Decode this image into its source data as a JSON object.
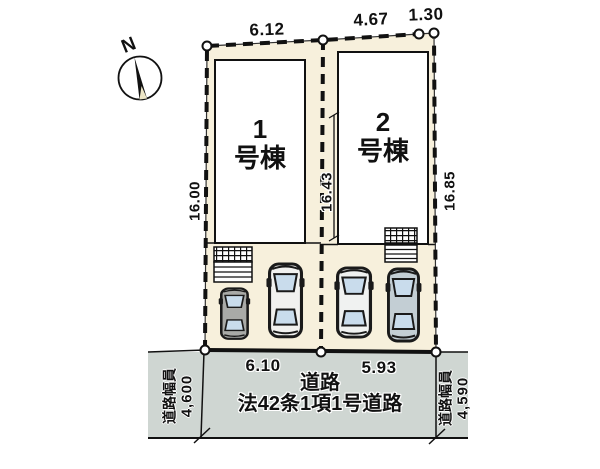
{
  "compass": {
    "north_label": "N"
  },
  "plot": {
    "buildings": [
      {
        "number": "1",
        "suffix": "号棟"
      },
      {
        "number": "2",
        "suffix": "号棟"
      }
    ],
    "dims": {
      "top_left": "6.12",
      "top_mid": "4.67",
      "top_right": "1.30",
      "side_left": "16.00",
      "side_mid": "16.43",
      "side_right": "16.85",
      "bottom_left": "6.10",
      "bottom_right": "5.93"
    }
  },
  "road": {
    "title": "道路",
    "subtitle": "法42条1項1号道路",
    "left_width": {
      "label": "道路幅員",
      "value": "4,600"
    },
    "right_width": {
      "label": "道路幅員",
      "value": "4,590"
    }
  },
  "colors": {
    "lot_fill": "#f7f0dc",
    "road_fill": "#cfd6d2",
    "building_fill": "#ffffff",
    "line": "#111111",
    "window_glass": "#c9dcec"
  },
  "icons": {
    "compass": "compass-north-icon",
    "car": "car-top-icon"
  }
}
